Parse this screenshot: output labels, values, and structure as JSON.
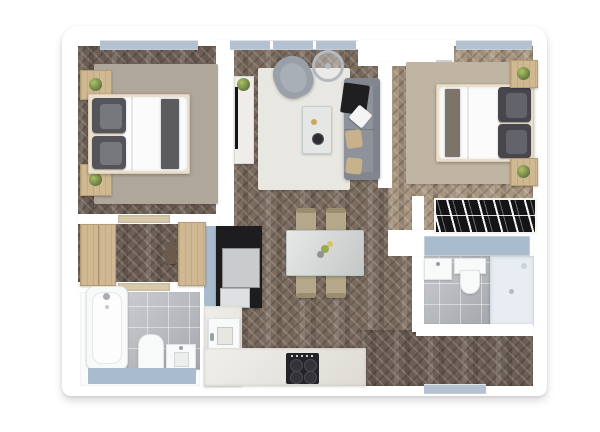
{
  "scene": {
    "description": "3D top-down rendering of a two-bedroom apartment floor plan on a white background",
    "view": "top-down",
    "visible_text": "none"
  },
  "colors": {
    "wall": "#ffffff",
    "floorDark": "#6d5f55",
    "floorMid": "#7c6c5f",
    "floorLight": "#a8957f",
    "window": "#b3c1d1",
    "tile": "#b7babf",
    "rugGray": "#b0a79b",
    "rugBeige": "#c0b4a2",
    "rugWhite": "#e9e7e2",
    "wood": "#d0b892",
    "sofa": "#8d929b",
    "armchair": "#9aa0a8",
    "pillowDark": "#54545a",
    "pillowTan": "#c8b28c",
    "throwBlack": "#1f1f22",
    "duvet": "#fbfbfb",
    "stone": "#ced2d1",
    "chair": "#b5a88a",
    "counter": "#e7e4dd",
    "cooktop": "#232327",
    "unitBlack": "#1d1d1f",
    "appliance": "#c9cbcd",
    "mat": "#a9bccd",
    "shower": "#e7edf3",
    "fixture": "#f8fafa",
    "plant": "#7f9350",
    "wardrobe": "#141416"
  },
  "rooms": [
    {
      "name": "bedroom-1",
      "position": "top-left",
      "furniture": [
        "double-bed",
        "two-pillow-stacks",
        "gray-runner",
        "nightstand-with-plant",
        "nightstand-with-plant",
        "gray-rug",
        "window"
      ]
    },
    {
      "name": "living-room",
      "position": "top-center",
      "furniture": [
        "sofa-with-throw-and-pillows",
        "armchair",
        "glass-coffee-table",
        "tv-console-with-plant",
        "white-rug",
        "round-decor",
        "window"
      ]
    },
    {
      "name": "bedroom-2",
      "position": "top-right",
      "furniture": [
        "double-bed",
        "two-pillow-stacks",
        "runner",
        "nightstand-with-plant",
        "nightstand-with-plant",
        "beige-rug",
        "open-wardrobe-with-clothes",
        "window"
      ]
    },
    {
      "name": "hallway",
      "position": "mid-left",
      "furniture": [
        "wood-cabinet",
        "wood-cabinet",
        "wall-rack"
      ]
    },
    {
      "name": "kitchen-dining",
      "position": "bottom-center",
      "furniture": [
        "dining-table-with-flowers",
        "four-chairs",
        "l-shaped-counter",
        "sink",
        "cooktop-4-burners",
        "tall-black-unit",
        "two-appliances",
        "blue-mat"
      ]
    },
    {
      "name": "bathroom-1",
      "position": "bottom-left",
      "furniture": [
        "bathtub",
        "toilet",
        "washbasin",
        "blue-bath-mat",
        "tiled-floor"
      ]
    },
    {
      "name": "bathroom-2",
      "position": "mid-right",
      "furniture": [
        "shower-tray",
        "wall-hung-toilet",
        "washbasin",
        "blue-dresser",
        "tiled-floor"
      ]
    },
    {
      "name": "entry",
      "position": "top-center-right",
      "furniture": [
        "entrance-door"
      ]
    }
  ]
}
